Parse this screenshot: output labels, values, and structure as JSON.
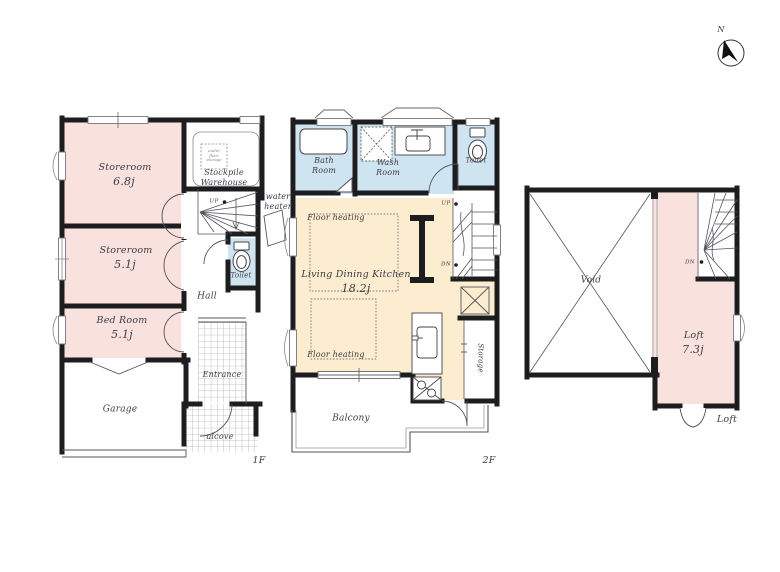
{
  "compass": {
    "north_label": "N"
  },
  "colors": {
    "wall": "#1d1d1f",
    "room_pink": "#f9e2de",
    "room_blue": "#cfe4f1",
    "room_cream": "#fcecd0",
    "text": "#3c3c46"
  },
  "floor_1f": {
    "label": "1F",
    "storeroom_a_name": "Storeroom",
    "storeroom_a_area": "6.8j",
    "storeroom_b_name": "Storeroom",
    "storeroom_b_area": "5.1j",
    "bedroom_name": "Bed Room",
    "bedroom_area": "5.1j",
    "stockpile_name": "Stockpile\nWarehouse",
    "stockpile_note": "under\nfloor\nstorage",
    "toilet": "Toilet",
    "hall": "Hall",
    "entrance": "Entrance",
    "alcove": "alcove",
    "garage": "Garage",
    "water_heater": "water\nheater",
    "up": "UP"
  },
  "floor_2f": {
    "label": "2F",
    "bath": "Bath\nRoom",
    "wash": "Wash\nRoom",
    "toilet": "Toilet",
    "ldk_name": "Living Dining Kitchen",
    "ldk_area": "18.2j",
    "floor_heating_a": "Floor heating",
    "floor_heating_b": "Floor heating",
    "storage": "Storage",
    "balcony": "Balcony",
    "up": "UP",
    "dn": "DN"
  },
  "loft": {
    "label": "Loft",
    "void": "Void",
    "loft_name": "Loft",
    "loft_area": "7.3j",
    "dn": "DN"
  }
}
